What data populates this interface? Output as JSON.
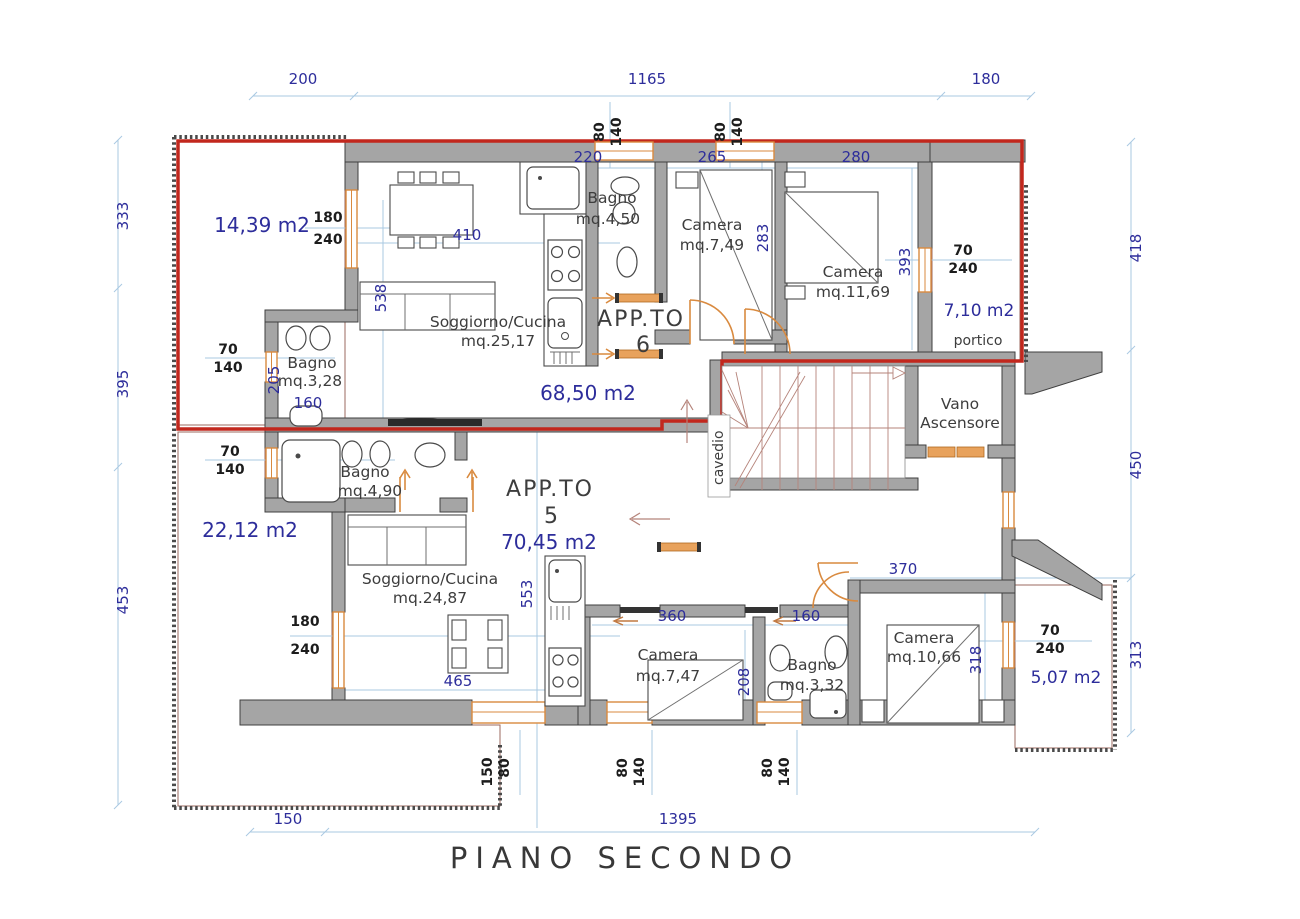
{
  "title": "PIANO SECONDO",
  "colors": {
    "wall": "#a5a5a5",
    "boundary_red": "#c2271d",
    "dim_text_blue": "#2d2d9b",
    "dim_line_blue": "#a9c9e2",
    "window_orange": "#d98a3f",
    "stair_brown": "#b5837a",
    "label_gray": "#3d3d3d"
  },
  "apartments": {
    "app6": {
      "name": "APP.TO",
      "number": "6",
      "area": "68,50 m2"
    },
    "app5": {
      "name": "APP.TO",
      "number": "5",
      "area": "70,45 m2"
    }
  },
  "rooms": {
    "soggiorno6": {
      "name": "Soggiorno/Cucina",
      "area": "mq.25,17"
    },
    "bagno6_main": {
      "name": "Bagno",
      "area": "mq.4,50"
    },
    "camera6_small": {
      "name": "Camera",
      "area": "mq.7,49"
    },
    "camera6_large": {
      "name": "Camera",
      "area": "mq.11,69"
    },
    "bagno6_small": {
      "name": "Bagno",
      "area": "mq.3,28"
    },
    "bagno5_main": {
      "name": "Bagno",
      "area": "mq.4,90"
    },
    "soggiorno5": {
      "name": "Soggiorno/Cucina",
      "area": "mq.24,87"
    },
    "camera5_small": {
      "name": "Camera",
      "area": "mq.7,47"
    },
    "bagno5_small": {
      "name": "Bagno",
      "area": "mq.3,32"
    },
    "camera5_large": {
      "name": "Camera",
      "area": "mq.10,66"
    },
    "elevator": {
      "line1": "Vano",
      "line2": "Ascensore"
    },
    "shaft": "cavedio"
  },
  "outdoor": {
    "terrace_upper": "14,39  m2",
    "terrace_lower": "22,12  m2",
    "portico_area": "7,10  m2",
    "portico": "portico",
    "balcony": "5,07  m2"
  },
  "dims_outer": {
    "top": [
      "200",
      "1165",
      "180"
    ],
    "left": [
      "333",
      "395",
      "453"
    ],
    "right": [
      "418",
      "450",
      "313"
    ],
    "bottom": [
      "150",
      "1395"
    ]
  },
  "dims_inner": {
    "d220": "220",
    "d265": "265",
    "d280": "280",
    "d283": "283",
    "d393": "393",
    "d410": "410",
    "d538": "538",
    "d205": "205",
    "d160a": "160",
    "d553": "553",
    "d465": "465",
    "d370": "370",
    "d360": "360",
    "d160b": "160",
    "d208": "208",
    "d318": "318"
  },
  "windows": {
    "w70": "70",
    "w80": "80",
    "w140": "140",
    "w150": "150",
    "w180": "180",
    "w240": "240"
  }
}
